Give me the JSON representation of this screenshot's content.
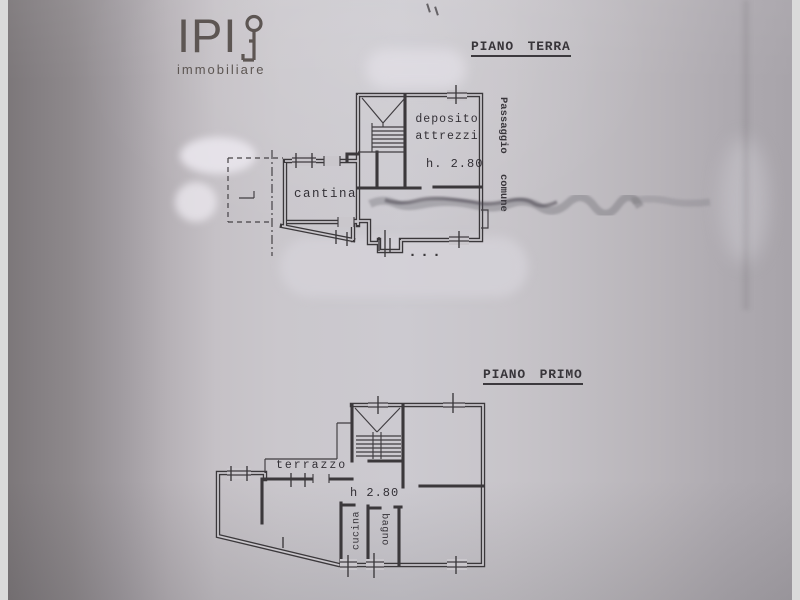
{
  "logo": {
    "brand": "IPI",
    "subtitle": "immobiliare"
  },
  "floors": [
    {
      "title": "PIANO TERRA",
      "rooms": {
        "cantina": "cantina",
        "deposito": "deposito attrezzi"
      },
      "height_note": "h. 2.80",
      "side_note": {
        "word1": "Passaggio",
        "word2": "comune"
      },
      "dots": "..."
    },
    {
      "title": "PIANO PRIMO",
      "rooms": {
        "terrazzo": "terrazzo",
        "cucina": "cucina",
        "bagno": "bagno"
      },
      "height_note": "h 2.80"
    }
  ]
}
